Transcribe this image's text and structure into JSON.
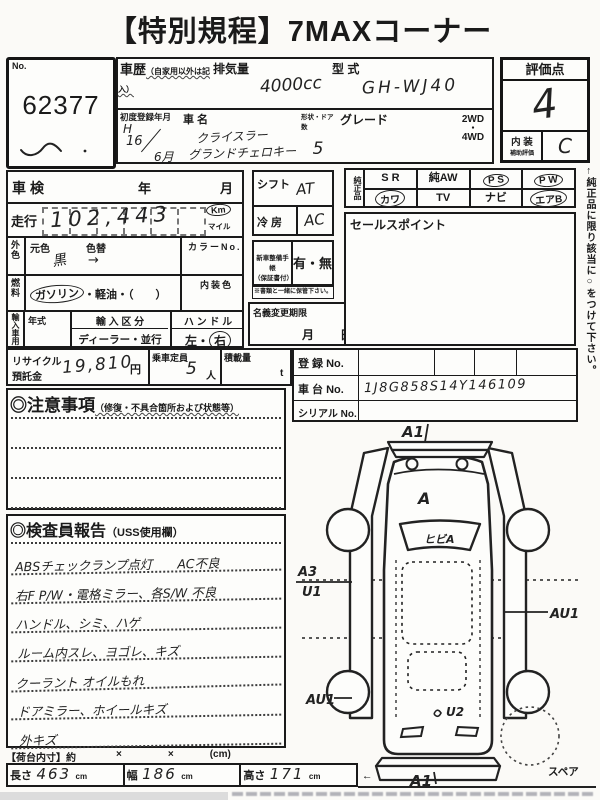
{
  "title": "【特別規程】7MAXコーナー",
  "lot": {
    "label": "No.",
    "number": "62377"
  },
  "veh": {
    "history_label": "車歴",
    "history_sub": "（自家用以外は記入）",
    "disp_label": "排気量",
    "disp_value": "4000cc",
    "model_label": "型 式",
    "model_value": "GH-WJ40",
    "firstreg_label": "初度登録年月",
    "firstreg": {
      "era": "H",
      "year": "16",
      "month": "6月"
    },
    "name_label": "車 名",
    "name1": "クライスラー",
    "name2": "グランドチェロキー",
    "doors_label": "形状・ドア数",
    "doors_value": "5",
    "grade_label": "グレード",
    "drive1": "2WD",
    "drive_dot": "・",
    "drive2": "4WD"
  },
  "rating": {
    "label": "評価点",
    "score": "4",
    "int1": "内 装",
    "int2": "補助評価",
    "int_value": "C"
  },
  "chk": {
    "label": "車検",
    "year": "年",
    "month": "月"
  },
  "run": {
    "label": "走行",
    "value": "102,443",
    "km": "Km",
    "mile": "マイル"
  },
  "color": {
    "tab": "外色",
    "base_label": "元色",
    "base_value": "黒",
    "change_label": "色替",
    "arrow": "→",
    "no_label": "カラーNo.",
    "int_label": "内装色"
  },
  "fuel": {
    "tab": "燃料",
    "gas": "ガソリン",
    "rest": "・軽油・（　　）"
  },
  "imp": {
    "tab": "輸入車用",
    "year_label": "年式",
    "div_label": "輸 入 区 分",
    "div_value": "ディーラー・並行",
    "handle_label": "ハ ン ド ル",
    "left": "左",
    "dot": "・",
    "right": "右"
  },
  "rec": {
    "label1": "リサイクル",
    "label2": "預託金",
    "value": "19,810",
    "yen": "円",
    "cap_label": "乗車定員",
    "cap_value": "5",
    "cap_unit": "人",
    "load_label": "積載量",
    "load_unit": "t"
  },
  "shift": {
    "label": "シフト",
    "value": "AT"
  },
  "ac": {
    "label": "冷 房",
    "value": "AC"
  },
  "book": {
    "l1": "新車整備手帳",
    "l2": "（保証書付）",
    "opts": "有・無",
    "note": "※書類と一緒に保管下さい。"
  },
  "transfer": {
    "label": "名義変更期限",
    "month": "月",
    "day": "日"
  },
  "gen": {
    "tab": "純正品",
    "r1": [
      "S R",
      "純AW",
      "P S",
      "P W"
    ],
    "r2": [
      "カワ",
      "TV",
      "ナビ",
      "エアB"
    ]
  },
  "sales": {
    "label": "セールスポイント"
  },
  "regi": {
    "reg_label": "登 録 No.",
    "chassis_label": "車 台 No.",
    "chassis_value": "1J8G858S14Y146109",
    "serial_label": "シリアル No."
  },
  "notes": {
    "label": "◎注意事項",
    "sub": "（修復・不具合箇所および状態等）"
  },
  "report": {
    "label": "◎検査員報告",
    "sub": "（USS使用欄）",
    "lines": [
      "ABSチェックランプ点灯　　AC不良",
      "右F P/W・電格ミラー、各S/W 不良",
      "ハンドル、シミ、ハゲ",
      "ルーム内スレ、ヨゴレ、キズ",
      "クーラント オイルもれ",
      "ドアミラー、ホイールキズ",
      "外キズ"
    ]
  },
  "cargo": {
    "label": "【荷台内寸】約",
    "x": "×",
    "unit": "(cm)"
  },
  "dims": {
    "len_label": "長さ",
    "len": "463",
    "w_label": "幅",
    "w": "186",
    "h_label": "高さ",
    "h": "171",
    "cm": "cm",
    "note": "←（車検証上の寸法）"
  },
  "side_note": "←純正品に限り該当に○をつけて下さい。",
  "diagram": {
    "a1_front": "A1",
    "hood": "A",
    "windshield": "ヒビA",
    "a3": "A3",
    "u1": "U1",
    "au1_left": "AU1",
    "au1_right": "AU1",
    "u2": "U2",
    "a1_rear": "A1",
    "spare": "スペア"
  }
}
